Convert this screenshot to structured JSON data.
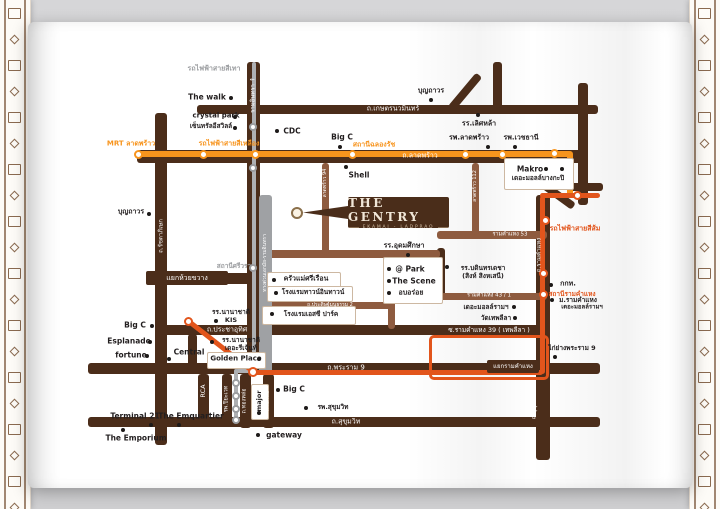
{
  "logo": {
    "title": "THE GENTRY",
    "subtitle": "EKAMAI - LADPRAO"
  },
  "colors": {
    "road": "#4b2d1a",
    "road_light": "#8e5b3f",
    "yellow": "#F7941D",
    "orange": "#E2551C",
    "gray_line": "#aeb0b3",
    "gray_bar": "#9fa1a4",
    "gray_text": "#9b9da0",
    "ink": "#221e1f",
    "card_border": "#cdb8a2",
    "ornament": "#8a6a50",
    "logo_bg": "#4a2d1a",
    "logo_text": "#f1e7d8",
    "pin_ring": "#8a6f4b"
  },
  "map": {
    "segments": [
      {
        "n": "road-kaset-nawamin",
        "x": 197,
        "y": 105,
        "w": 401,
        "h": 9,
        "c": "road"
      },
      {
        "n": "road-ladprao",
        "x": 137,
        "y": 150,
        "w": 446,
        "h": 13,
        "c": "road"
      },
      {
        "n": "road-liapduan-corridor",
        "x": 247,
        "y": 62,
        "w": 13,
        "h": 312,
        "c": "road"
      },
      {
        "n": "road-ratchadaphisek-asoke",
        "x": 155,
        "y": 113,
        "w": 12,
        "h": 332,
        "c": "road"
      },
      {
        "n": "road-huaikhwang-spur",
        "x": 167,
        "y": 273,
        "w": 85,
        "h": 11,
        "c": "road"
      },
      {
        "n": "road-prachauthit-ram39",
        "x": 160,
        "y": 325,
        "w": 380,
        "h": 10,
        "c": "road"
      },
      {
        "n": "road-rama9",
        "x": 88,
        "y": 363,
        "w": 512,
        "h": 11,
        "c": "road"
      },
      {
        "n": "road-sukhumvit",
        "x": 88,
        "y": 417,
        "w": 512,
        "h": 10,
        "c": "road"
      },
      {
        "n": "road-right-vertical",
        "x": 578,
        "y": 83,
        "w": 10,
        "h": 122,
        "c": "road"
      },
      {
        "n": "road-top-vertical",
        "x": 493,
        "y": 62,
        "w": 9,
        "h": 46,
        "c": "road"
      },
      {
        "n": "road-branch-east",
        "x": 570,
        "y": 183,
        "w": 33,
        "h": 8,
        "c": "road"
      },
      {
        "n": "road-diagonal-top",
        "x": 461,
        "y": 70,
        "w": 8,
        "h": 44,
        "c": "road",
        "rot": 40
      },
      {
        "n": "road-diagonal-right",
        "x": 541,
        "y": 192,
        "w": 36,
        "h": 8,
        "c": "road",
        "rot": 36
      },
      {
        "n": "road-ramkhamhaeng",
        "x": 536,
        "y": 195,
        "w": 14,
        "h": 265,
        "c": "road"
      },
      {
        "n": "road-connector-udomsuksa",
        "x": 437,
        "y": 248,
        "w": 8,
        "h": 52,
        "c": "road"
      },
      {
        "n": "road-soi-left",
        "x": 188,
        "y": 334,
        "w": 9,
        "h": 37,
        "c": "road"
      },
      {
        "n": "road-rca",
        "x": 198,
        "y": 374,
        "w": 11,
        "h": 46,
        "c": "road"
      },
      {
        "n": "road-piyavate",
        "x": 222,
        "y": 374,
        "w": 10,
        "h": 50,
        "c": "road"
      },
      {
        "n": "road-thonglor",
        "x": 240,
        "y": 374,
        "w": 11,
        "h": 54,
        "c": "road"
      },
      {
        "n": "road-ekamai",
        "x": 263,
        "y": 374,
        "w": 11,
        "h": 54,
        "c": "road"
      },
      {
        "n": "road-intharaporn",
        "x": 260,
        "y": 250,
        "w": 180,
        "h": 8,
        "c": "road_light"
      },
      {
        "n": "road-ram53",
        "x": 437,
        "y": 231,
        "w": 110,
        "h": 8,
        "c": "road_light"
      },
      {
        "n": "road-ram43-1",
        "x": 440,
        "y": 293,
        "w": 107,
        "h": 7,
        "c": "road_light"
      },
      {
        "n": "road-praditmanutham2",
        "x": 260,
        "y": 302,
        "w": 132,
        "h": 7,
        "c": "road_light"
      },
      {
        "n": "road-soi-mid",
        "x": 388,
        "y": 253,
        "w": 7,
        "h": 76,
        "c": "road_light"
      },
      {
        "n": "road-soi-ladprao94",
        "x": 322,
        "y": 163,
        "w": 7,
        "h": 92,
        "c": "road_light"
      },
      {
        "n": "road-soi-ladprao112",
        "x": 472,
        "y": 163,
        "w": 7,
        "h": 72,
        "c": "road_light"
      },
      {
        "n": "expressway-bar",
        "x": 259,
        "y": 195,
        "w": 13,
        "h": 179,
        "c": "gray_bar"
      },
      {
        "n": "gray-line-vertical",
        "x": 252,
        "y": 62,
        "w": 4,
        "h": 311,
        "c": "gray_line",
        "z": 4
      },
      {
        "n": "gray-line-jog",
        "x": 236,
        "y": 369,
        "w": 18,
        "h": 4,
        "c": "gray_line",
        "z": 4
      },
      {
        "n": "gray-line-down",
        "x": 234,
        "y": 369,
        "w": 4,
        "h": 53,
        "c": "gray_line",
        "z": 4
      },
      {
        "n": "yellow-line",
        "x": 136,
        "y": 151,
        "w": 436,
        "h": 6,
        "c": "yellow",
        "z": 4
      },
      {
        "n": "yellow-line-down",
        "x": 567,
        "y": 151,
        "w": 6,
        "h": 47,
        "c": "yellow",
        "z": 4
      },
      {
        "n": "orange-line-diagonal",
        "x": 179,
        "y": 344,
        "w": 84,
        "h": 5,
        "c": "orange",
        "rot": 38,
        "z": 4
      },
      {
        "n": "orange-line-rama9",
        "x": 250,
        "y": 370,
        "w": 293,
        "h": 5,
        "c": "orange",
        "z": 4
      },
      {
        "n": "orange-line-ramkhamhaeng",
        "x": 540,
        "y": 196,
        "w": 5,
        "h": 178,
        "c": "orange",
        "z": 4
      },
      {
        "n": "orange-line-top",
        "x": 540,
        "y": 193,
        "w": 60,
        "h": 5,
        "c": "orange",
        "z": 4
      }
    ],
    "spur": {
      "n": "orange-line-thepleela-loop",
      "x": 429,
      "y": 335,
      "w": 114,
      "h": 39
    },
    "stations": [
      {
        "x": 138,
        "y": 154,
        "r": 4.5,
        "c": "yellow"
      },
      {
        "x": 203,
        "y": 154,
        "r": 4.5,
        "c": "yellow"
      },
      {
        "x": 255,
        "y": 154,
        "r": 4.5,
        "c": "yellow"
      },
      {
        "x": 352,
        "y": 154,
        "r": 4.5,
        "c": "yellow"
      },
      {
        "x": 465,
        "y": 154,
        "r": 4.5,
        "c": "yellow"
      },
      {
        "x": 502,
        "y": 154,
        "r": 4.5,
        "c": "yellow"
      },
      {
        "x": 554,
        "y": 153,
        "r": 4.5,
        "c": "yellow"
      },
      {
        "x": 188,
        "y": 321,
        "r": 4.5,
        "c": "orange"
      },
      {
        "x": 253,
        "y": 372,
        "r": 5,
        "c": "orange"
      },
      {
        "x": 545,
        "y": 220,
        "r": 4.5,
        "c": "orange"
      },
      {
        "x": 543,
        "y": 273,
        "r": 4.5,
        "c": "orange"
      },
      {
        "x": 543,
        "y": 294,
        "r": 4.5,
        "c": "orange"
      },
      {
        "x": 577,
        "y": 195,
        "r": 4.5,
        "c": "orange"
      },
      {
        "x": 253,
        "y": 127,
        "r": 4,
        "c": "gray_text"
      },
      {
        "x": 253,
        "y": 168,
        "r": 4,
        "c": "gray_text"
      },
      {
        "x": 253,
        "y": 268,
        "r": 4,
        "c": "gray_text"
      },
      {
        "x": 236,
        "y": 383,
        "r": 4,
        "c": "gray_text"
      },
      {
        "x": 236,
        "y": 396,
        "r": 4,
        "c": "gray_text"
      },
      {
        "x": 236,
        "y": 409,
        "r": 4,
        "c": "gray_text"
      },
      {
        "x": 236,
        "y": 420,
        "r": 4,
        "c": "gray_text"
      }
    ],
    "cards": [
      {
        "n": "card-makro",
        "x": 504,
        "y": 158,
        "w": 68,
        "h": 30
      },
      {
        "n": "card-krua-maesri",
        "x": 267,
        "y": 272,
        "w": 72,
        "h": 14
      },
      {
        "n": "card-town-in-town",
        "x": 267,
        "y": 286,
        "w": 84,
        "h": 14
      },
      {
        "n": "card-sc-park",
        "x": 262,
        "y": 306,
        "w": 92,
        "h": 17
      },
      {
        "n": "card-golden-place",
        "x": 207,
        "y": 352,
        "w": 57,
        "h": 15
      },
      {
        "n": "card-at-park",
        "x": 383,
        "y": 257,
        "w": 58,
        "h": 45
      },
      {
        "n": "card-major",
        "x": 251,
        "y": 384,
        "w": 16,
        "h": 34
      }
    ],
    "intersections": [
      {
        "t": "แยกห้วยขวาง",
        "x": 146,
        "y": 271,
        "w": 82,
        "h": 14,
        "fs": 7
      },
      {
        "t": "แยกรามคำแหง",
        "x": 487,
        "y": 360,
        "w": 52,
        "h": 13,
        "fs": 6
      }
    ],
    "road_labels": [
      {
        "t": "ถ.เกษตรนวมินทร์",
        "x": 393,
        "y": 109,
        "fs": 7
      },
      {
        "t": "ถ.ลาดพร้าว",
        "x": 420,
        "y": 156,
        "fs": 7
      },
      {
        "t": "ถ.ประชาอุทิศ",
        "x": 227,
        "y": 330,
        "fs": 7
      },
      {
        "t": "ซ.รามคำแหง 39 ( เทพลีลา )",
        "x": 489,
        "y": 330,
        "fs": 6.5
      },
      {
        "t": "ถ.พระราม 9",
        "x": 346,
        "y": 368,
        "fs": 7
      },
      {
        "t": "ถ.สุขุมวิท",
        "x": 346,
        "y": 422,
        "fs": 7
      },
      {
        "t": "รามคำแหง 53",
        "x": 510,
        "y": 235,
        "fs": 5.5
      },
      {
        "t": "รามคำแหง 43 / 1",
        "x": 489,
        "y": 296,
        "fs": 5.5
      },
      {
        "t": "ถ.ประดิษฐ์มนูธรรม 2",
        "x": 330,
        "y": 305,
        "fs": 5
      },
      {
        "t": "ถ.รัชดาภิเษก",
        "x": 161,
        "y": 236,
        "fs": 6,
        "vert": true
      },
      {
        "t": "รามอินทรา ↑",
        "x": 253,
        "y": 95,
        "fs": 6,
        "vert": true
      },
      {
        "t": "ทางด่วนเอกมัย-รามอินทรา",
        "x": 265,
        "y": 263,
        "fs": 5,
        "vert": true
      },
      {
        "t": "ถ.รามคำแหง",
        "x": 539,
        "y": 255,
        "fs": 6,
        "vert": true
      },
      {
        "t": "ถ.สุขุมวิท 71",
        "x": 534,
        "y": 402,
        "fs": 6,
        "vert": true
      },
      {
        "t": "ถ.ทองหล่อ",
        "x": 245,
        "y": 401,
        "fs": 5.5,
        "vert": true
      },
      {
        "t": "ถ.เอกมัย",
        "x": 268,
        "y": 401,
        "fs": 5.5,
        "vert": true
      },
      {
        "t": "RCA",
        "x": 203,
        "y": 391,
        "fs": 6.5,
        "vert": true
      },
      {
        "t": "รพ.ปิยะเวท",
        "x": 227,
        "y": 399,
        "fs": 5.5,
        "vert": true
      },
      {
        "t": "ลาดพร้าว 94",
        "x": 325,
        "y": 183,
        "fs": 5,
        "vert": true
      },
      {
        "t": "ลาดพร้าว 112",
        "x": 475,
        "y": 186,
        "fs": 5,
        "vert": true
      }
    ],
    "transit_labels": [
      {
        "t": "รถไฟฟ้าสายสีเทา",
        "x": 214,
        "y": 69,
        "c": "gray_text",
        "fs": 7
      },
      {
        "t": "MRT ลาดพร้าว",
        "x": 131,
        "y": 144,
        "c": "yellow",
        "fs": 7
      },
      {
        "t": "รถไฟฟ้าสายสีเหลือง",
        "x": 229,
        "y": 144,
        "c": "yellow",
        "fs": 7
      },
      {
        "t": "สถานีฉลองรัช",
        "x": 374,
        "y": 145,
        "c": "yellow",
        "fs": 7
      },
      {
        "t": "รถไฟฟ้าสายสีส้ม",
        "x": 575,
        "y": 229,
        "c": "orange",
        "fs": 7
      },
      {
        "t": "สถานีรามคำแหง",
        "x": 572,
        "y": 294,
        "c": "orange",
        "fs": 6.5
      },
      {
        "t": "สถานีศรีวรา",
        "x": 234,
        "y": 266,
        "c": "gray_text",
        "fs": 6.5
      }
    ],
    "pois": [
      {
        "t": "The walk",
        "x": 207,
        "y": 97,
        "fs": 7.5,
        "dots": [
          [
            231,
            98
          ]
        ]
      },
      {
        "t": "crystal park",
        "x": 216,
        "y": 116,
        "dots": [
          [
            235,
            117
          ]
        ]
      },
      {
        "t": "เซ็นทรัลอีสวิลล์",
        "x": 211,
        "y": 126,
        "fs": 6.5,
        "dots": [
          [
            235,
            128
          ]
        ]
      },
      {
        "t": "CDC",
        "x": 292,
        "y": 131,
        "fs": 7.5,
        "dots": [
          [
            277,
            131
          ]
        ]
      },
      {
        "t": "Big C",
        "x": 342,
        "y": 137,
        "fs": 7.5,
        "dots": [
          [
            340,
            147
          ]
        ]
      },
      {
        "t": "Shell",
        "x": 359,
        "y": 175,
        "fs": 7.5,
        "dots": [
          [
            346,
            167
          ]
        ]
      },
      {
        "t": "บุญถาวร",
        "x": 431,
        "y": 91,
        "dots": [
          [
            431,
            100
          ]
        ]
      },
      {
        "t": "รร.เลิศหล้า",
        "x": 479,
        "y": 124,
        "dots": [
          [
            478,
            115
          ]
        ]
      },
      {
        "t": "รพ.ลาดพร้าว",
        "x": 469,
        "y": 138,
        "dots": [
          [
            488,
            147
          ]
        ]
      },
      {
        "t": "รพ.เวชธานี",
        "x": 521,
        "y": 138,
        "dots": [
          [
            515,
            147
          ]
        ]
      },
      {
        "t": "Makro",
        "x": 530,
        "y": 169,
        "fs": 7.5,
        "dots": [
          [
            546,
            169
          ],
          [
            562,
            169
          ]
        ]
      },
      {
        "t": "เดอะมอลล์บางกะปิ",
        "x": 538,
        "y": 178,
        "fs": 6.5,
        "dots": []
      },
      {
        "t": "บุญถาวร",
        "x": 131,
        "y": 212,
        "dots": [
          [
            149,
            214
          ]
        ]
      },
      {
        "t": "รร.อุดมศึกษา",
        "x": 404,
        "y": 246,
        "dots": [
          [
            408,
            255
          ]
        ]
      },
      {
        "t": "รร.บดินทรเดชา\n(สิงห์ สิงหเสนี)",
        "x": 483,
        "y": 272,
        "fs": 6.5,
        "dots": [
          [
            447,
            267
          ]
        ]
      },
      {
        "t": "@ Park",
        "x": 410,
        "y": 269,
        "fs": 7.5,
        "dots": [
          [
            389,
            269
          ]
        ]
      },
      {
        "t": "The Scene",
        "x": 414,
        "y": 281,
        "fs": 7.5,
        "dots": [
          [
            389,
            281
          ]
        ]
      },
      {
        "t": "อบอร่อย",
        "x": 411,
        "y": 293,
        "dots": [
          [
            389,
            293
          ]
        ]
      },
      {
        "t": "ครัวแม่ศรีเรือน",
        "x": 306,
        "y": 279,
        "dots": [
          [
            274,
            280
          ]
        ]
      },
      {
        "t": "โรงแรมทาวน์อินทาวน์",
        "x": 313,
        "y": 292,
        "fs": 6.5,
        "dots": [
          [
            276,
            293
          ]
        ]
      },
      {
        "t": "โรงแรมเอสซี ปาร์ค",
        "x": 311,
        "y": 314,
        "fs": 6.5,
        "dots": [
          [
            272,
            314
          ]
        ]
      },
      {
        "t": "กกท.",
        "x": 568,
        "y": 284,
        "dots": [
          [
            551,
            285
          ]
        ]
      },
      {
        "t": "ม.รามคำแหง",
        "x": 578,
        "y": 300,
        "fs": 6.5,
        "dots": [
          [
            552,
            300
          ]
        ]
      },
      {
        "t": "เดอะมอลล์รามฯ",
        "x": 582,
        "y": 307,
        "fs": 6,
        "dots": []
      },
      {
        "t": "เดอะมอลล์รามฯ",
        "x": 486,
        "y": 307,
        "fs": 6.5,
        "dots": [
          [
            514,
            307
          ]
        ]
      },
      {
        "t": "วัดเทพลีลา",
        "x": 496,
        "y": 318,
        "fs": 6.5,
        "dots": [
          [
            515,
            318
          ]
        ]
      },
      {
        "t": "ไก่ย่างพระราม 9",
        "x": 572,
        "y": 348,
        "fs": 6.5,
        "dots": [
          [
            555,
            357
          ]
        ]
      },
      {
        "t": "Big C",
        "x": 135,
        "y": 325,
        "fs": 7.5,
        "dots": [
          [
            152,
            326
          ]
        ]
      },
      {
        "t": "Esplanade",
        "x": 129,
        "y": 341,
        "fs": 7.5,
        "dots": [
          [
            150,
            342
          ]
        ]
      },
      {
        "t": "fortune",
        "x": 131,
        "y": 355,
        "fs": 7.5,
        "dots": [
          [
            147,
            356
          ]
        ]
      },
      {
        "t": "Central",
        "x": 189,
        "y": 352,
        "fs": 7.5,
        "dots": [
          [
            169,
            359
          ]
        ]
      },
      {
        "t": "Golden Place",
        "x": 236,
        "y": 359,
        "fs": 7,
        "dots": [
          [
            259,
            359
          ]
        ]
      },
      {
        "t": "รร.นานาชาติ\nKIS",
        "x": 231,
        "y": 316,
        "fs": 6.5,
        "dots": [
          [
            216,
            321
          ]
        ]
      },
      {
        "t": "รร.นานาชาติ\nเดอะรีเจ้นท์",
        "x": 241,
        "y": 344,
        "fs": 6.5,
        "dots": [
          [
            212,
            342
          ]
        ]
      },
      {
        "t": "Terminal 21",
        "x": 135,
        "y": 416,
        "fs": 7.5,
        "dots": [
          [
            151,
            425
          ]
        ]
      },
      {
        "t": "The Emquartier",
        "x": 191,
        "y": 416,
        "fs": 7.5,
        "dots": [
          [
            179,
            425
          ]
        ]
      },
      {
        "t": "The Emporium",
        "x": 136,
        "y": 438,
        "fs": 7.5,
        "dots": [
          [
            123,
            430
          ]
        ]
      },
      {
        "t": "รพ.สุขุมวิท",
        "x": 333,
        "y": 407,
        "fs": 6.5,
        "dots": [
          [
            306,
            408
          ]
        ]
      },
      {
        "t": "Big C",
        "x": 294,
        "y": 389,
        "fs": 7.5,
        "dots": [
          [
            278,
            390
          ]
        ]
      },
      {
        "t": "gateway",
        "x": 284,
        "y": 435,
        "fs": 7.5,
        "dots": [
          [
            258,
            435
          ]
        ]
      },
      {
        "t": "major",
        "x": 259,
        "y": 401,
        "fs": 6.5,
        "vert": true,
        "dots": [
          [
            259,
            413
          ]
        ]
      }
    ]
  }
}
